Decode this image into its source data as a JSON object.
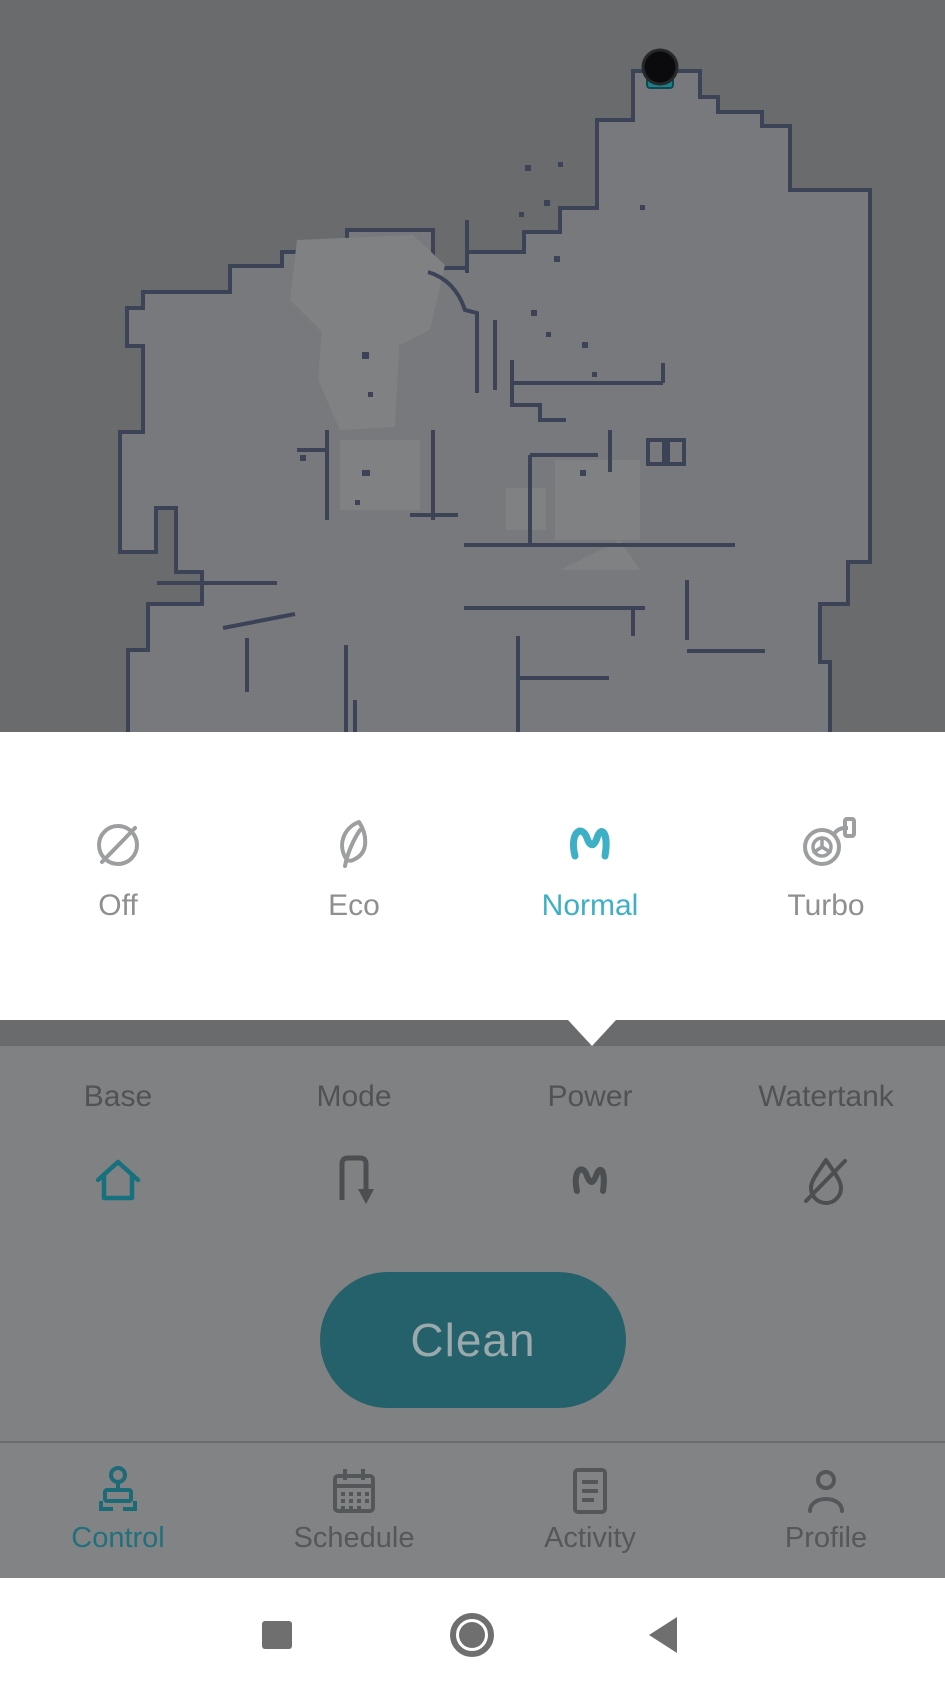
{
  "app": {
    "type": "robot-vacuum-control-screen",
    "dimmed_overlay": true
  },
  "map": {
    "name": "cleaning-map",
    "robot_marker": "robot-dock-marker",
    "colors": {
      "background": "#696b6d",
      "floor": "#77797c",
      "floor_highlight": "#7f8183",
      "wall": "#3c4357",
      "robot": "#0b0b0d",
      "dock": "#1d7f8c"
    }
  },
  "power_popup": {
    "options": [
      {
        "label": "Off",
        "icon": "power-off-icon",
        "selected": false
      },
      {
        "label": "Eco",
        "icon": "leaf-icon",
        "selected": false
      },
      {
        "label": "Normal",
        "icon": "wave-icon",
        "selected": true
      },
      {
        "label": "Turbo",
        "icon": "turbo-icon",
        "selected": false
      }
    ],
    "selected_value": "Normal",
    "accent_color": "#3db0c5",
    "inactive_color": "#9c9ea0",
    "background": "#ffffff"
  },
  "control_panel": {
    "items": [
      {
        "label": "Base",
        "icon": "home-icon",
        "active": true
      },
      {
        "label": "Mode",
        "icon": "route-icon",
        "active": false
      },
      {
        "label": "Power",
        "icon": "wave-icon",
        "active": false
      },
      {
        "label": "Watertank",
        "icon": "water-off-icon",
        "active": false
      }
    ],
    "clean_button_label": "Clean",
    "clean_button_color": "#25616b",
    "active_icon_color": "#17707e",
    "inactive_icon_color": "#4b4f52"
  },
  "bottom_nav": {
    "items": [
      {
        "label": "Control",
        "icon": "joystick-icon",
        "active": true
      },
      {
        "label": "Schedule",
        "icon": "calendar-icon",
        "active": false
      },
      {
        "label": "Activity",
        "icon": "activity-icon",
        "active": false
      },
      {
        "label": "Profile",
        "icon": "profile-icon",
        "active": false
      }
    ],
    "active_color": "#20707e",
    "inactive_color": "#55585a"
  },
  "system_nav": {
    "buttons": [
      {
        "name": "recents",
        "icon": "square-icon"
      },
      {
        "name": "home",
        "icon": "circle-icon"
      },
      {
        "name": "back",
        "icon": "triangle-left-icon"
      }
    ],
    "icon_color": "#6f6f6f",
    "background": "#ffffff"
  }
}
